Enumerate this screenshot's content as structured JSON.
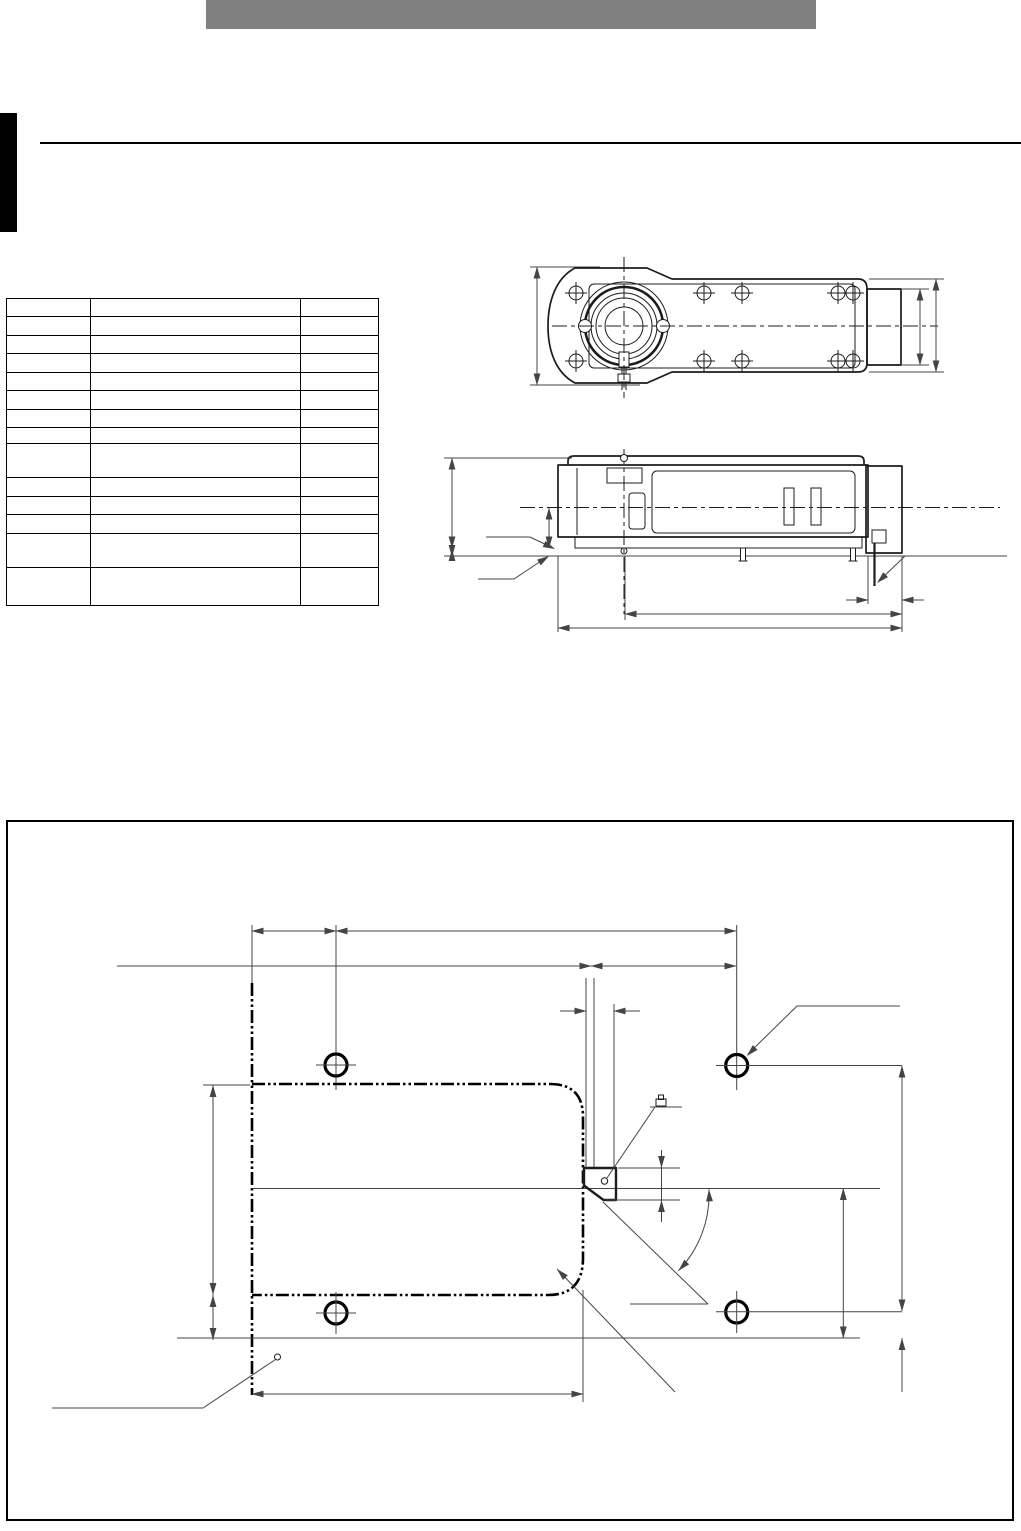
{
  "page": {
    "width": 1021,
    "height": 1531
  },
  "colors": {
    "page_bg": "#ffffff",
    "header_bar": "#808080",
    "tab": "#000000",
    "rule": "#000000",
    "table_border": "#000000",
    "ink": "#1c1c1c",
    "dim": "#444444"
  },
  "header": {
    "title_text": ""
  },
  "spec_table": {
    "columns": [
      "",
      "",
      ""
    ],
    "col_widths": [
      83,
      209,
      77
    ],
    "row_heights": [
      17,
      18,
      17,
      18,
      17,
      18,
      17,
      15,
      33,
      18,
      17,
      18,
      33,
      37
    ],
    "cells_empty": true
  },
  "drawings": {
    "top_view": {
      "screw_hole_count": 10,
      "hub": "concentric-circles"
    },
    "side_view": {
      "slot_count": 2,
      "leg_count": 2
    },
    "installation_diagram": {
      "mounting_hole_count": 4,
      "outline_style": "phantom-dash-dot-dot"
    }
  }
}
